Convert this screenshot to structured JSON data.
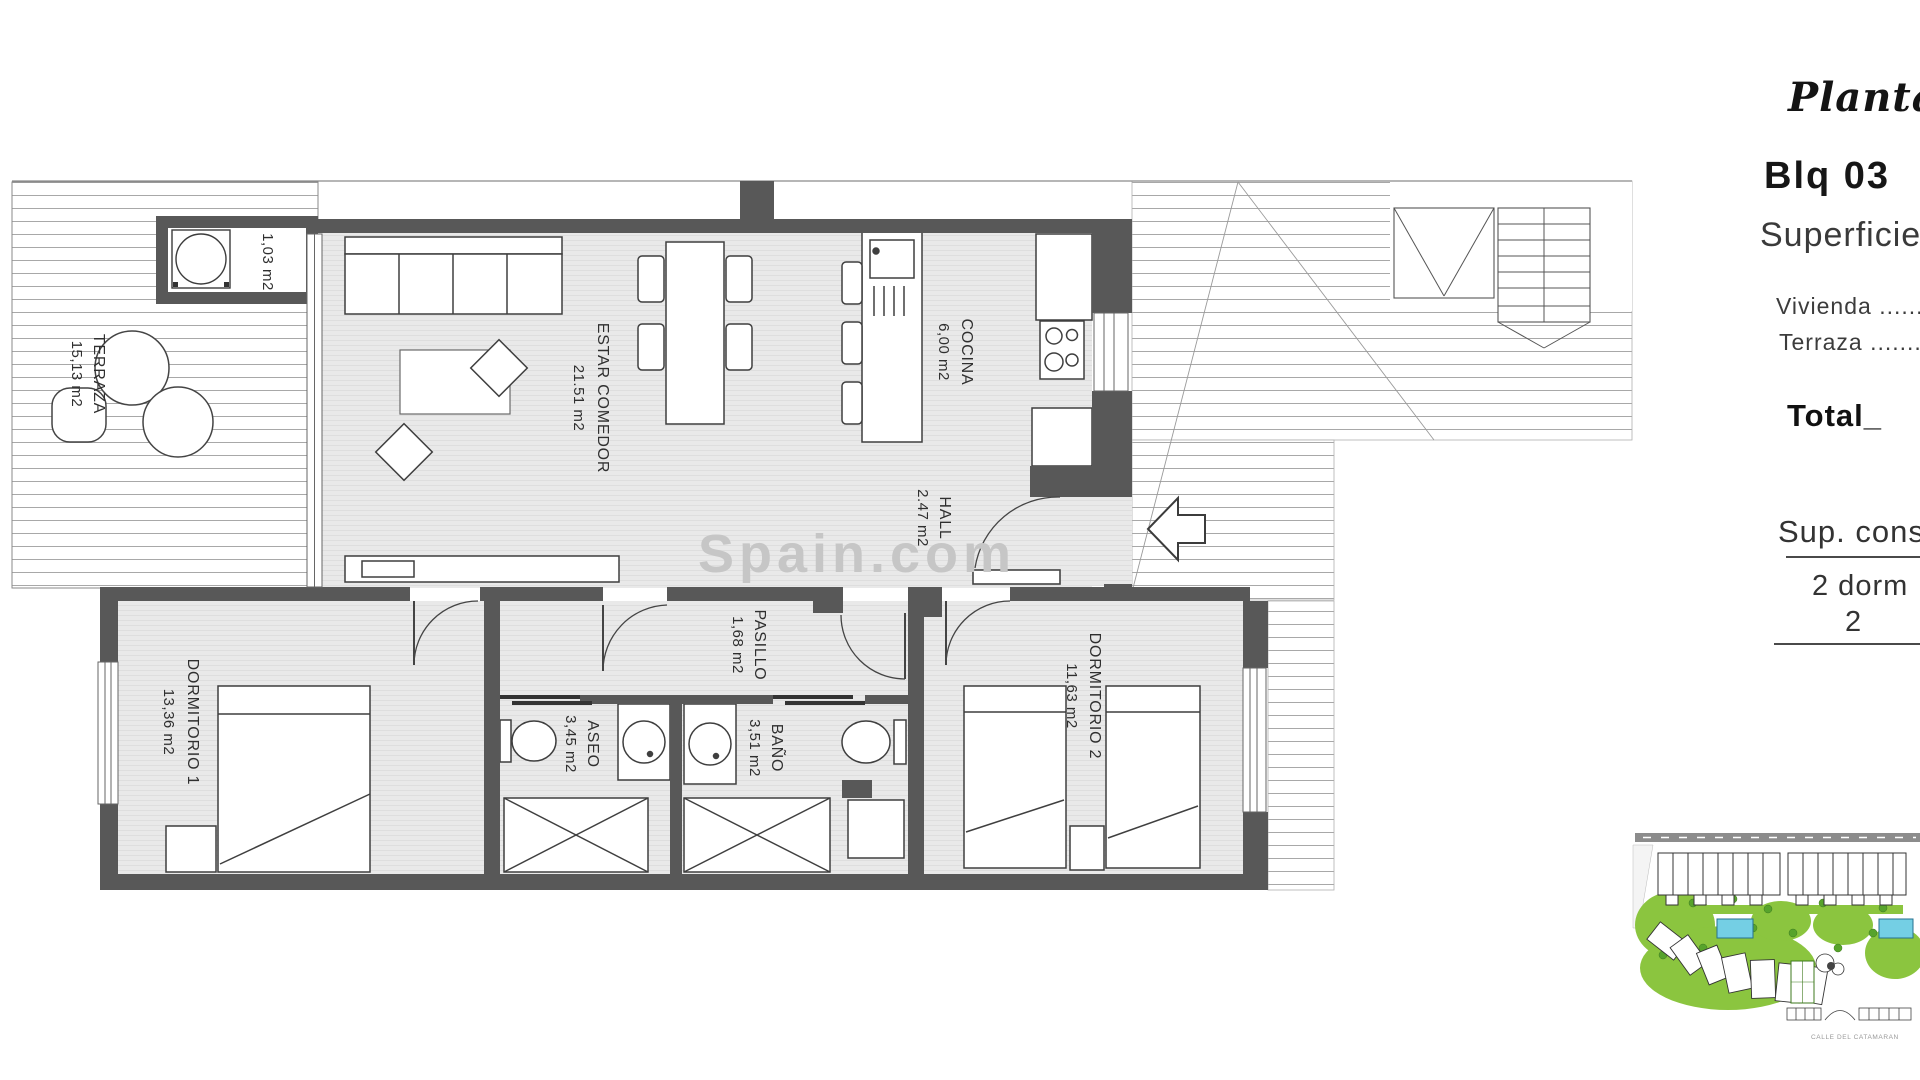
{
  "panel": {
    "plan_title": "Planta T",
    "block": "Blq 03",
    "surfaces_heading": "Superficie",
    "vivienda_row": "Vivienda ..........",
    "terraza_row": "Terraza ............",
    "total_label": "Total_",
    "total_value": "9",
    "sup_cons": "Sup. cons",
    "dorm_row_line1": "2 dorm",
    "dorm_row_line2": "2"
  },
  "watermark": "Spain.com",
  "rooms": {
    "terraza": {
      "name": "TERRAZA",
      "area": "15,13 m2"
    },
    "lavadero": {
      "area": "1,03 m2"
    },
    "estar_comedor": {
      "name": "ESTAR COMEDOR",
      "area": "21.51 m2"
    },
    "cocina": {
      "name": "COCINA",
      "area": "6,00 m2"
    },
    "hall": {
      "name": "HALL",
      "area": "2.47 m2"
    },
    "pasillo": {
      "name": "PASILLO",
      "area": "1,68 m2"
    },
    "aseo": {
      "name": "ASEO",
      "area": "3,45 m2"
    },
    "bano": {
      "name": "BAÑO",
      "area": "3,51 m2"
    },
    "dormitorio1": {
      "name": "DORMITORIO 1",
      "area": "13,36 m2"
    },
    "dormitorio2": {
      "name": "DORMITORIO 2",
      "area": "11,63 m2"
    }
  },
  "site_plan": {
    "street_label": "CALLE DEL CATAMARAN"
  },
  "colors": {
    "wall": "#585858",
    "floor": "#e9e9e9",
    "green": "#8bc53f",
    "pool": "#74cfe4"
  }
}
